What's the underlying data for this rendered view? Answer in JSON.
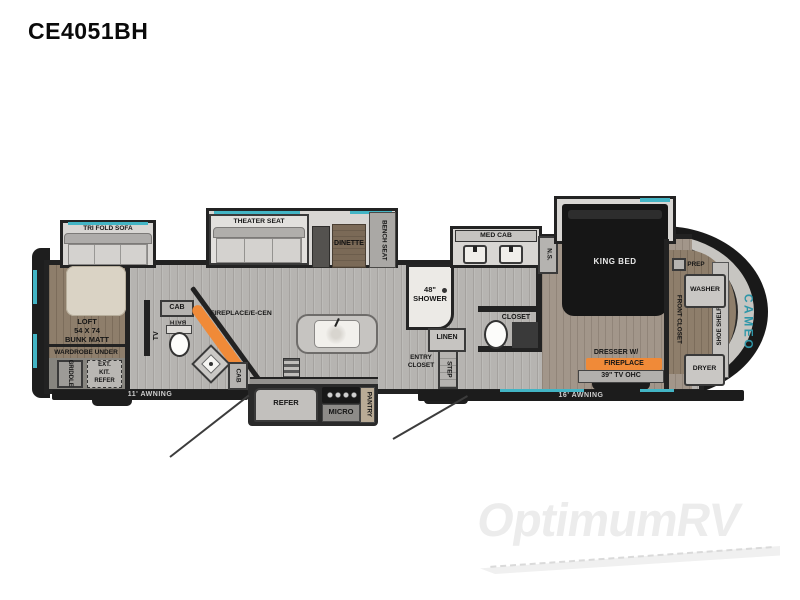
{
  "title": "CE4051BH",
  "watermark": "OptimumRV",
  "colors": {
    "accent_teal": "#43b5c5",
    "accent_orange": "#f08a38",
    "wall_dark": "#222222",
    "floor_gray": "#b6b4b1",
    "floor_brown": "#8e7e6b",
    "brand_teal": "#2f96a8"
  },
  "rear": {
    "tri_fold_sofa": "TRI FOLD SOFA",
    "loft_l1": "LOFT",
    "loft_l2": "54 X 74",
    "loft_l3": "BUNK MATT",
    "wardrobe": "WARDROBE UNDER",
    "griddle": "GRIDDLE",
    "ext_kit_l1": "EXT.",
    "ext_kit_l2": "KIT.",
    "ext_kit_l3": "REFER"
  },
  "half_bath": {
    "tv": "TV",
    "cab_upper": "CAB",
    "bath": "BATH",
    "fireplace": "FIREPLACE/E-CEN",
    "cab_lower": "CAB"
  },
  "living": {
    "theater_seat": "THEATER SEAT",
    "dinette": "DINETTE",
    "bench_seat": "BENCH SEAT"
  },
  "kitchen": {
    "refer": "REFER",
    "micro": "MICRO",
    "pantry": "PANTRY"
  },
  "bathroom": {
    "med_cab": "MED CAB",
    "shower_l1": "48\"",
    "shower_l2": "SHOWER",
    "linen": "LINEN",
    "entry_l1": "ENTRY",
    "entry_l2": "CLOSET",
    "step": "STEP",
    "closet": "CLOSET"
  },
  "bedroom": {
    "king_bed": "KING BED",
    "ns": "N.S.",
    "dresser_l1": "DRESSER W/",
    "dresser_l2": "FIREPLACE",
    "tv_ohc": "39\" TV OHC"
  },
  "front": {
    "prep": "PREP",
    "washer": "WASHER",
    "dryer": "DRYER",
    "shoe_shelf": "SHOE SHELF",
    "front_closet": "FRONT CLOSET",
    "brand": "CAMEO"
  },
  "exterior": {
    "awning_left": "11' AWNING",
    "awning_right": "16' AWNING"
  }
}
